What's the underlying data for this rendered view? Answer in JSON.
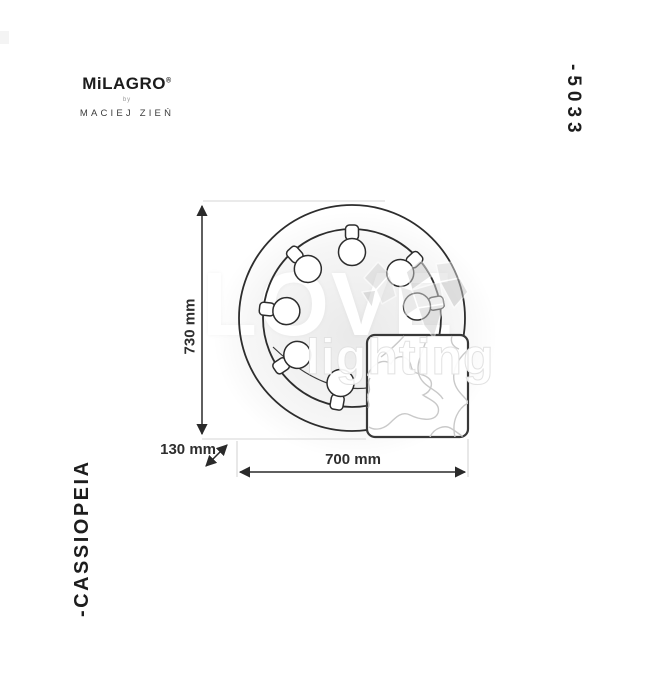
{
  "brand": {
    "name": "MiLAGRO",
    "registered_mark": "®",
    "by_label": "by",
    "designer": "MACIEJ ZIEŃ"
  },
  "product": {
    "model_number": "-5033",
    "name": "-CASSIOPEIA"
  },
  "dimensions": {
    "height": "730 mm",
    "width": "700 mm",
    "depth": "130 mm"
  },
  "watermark": {
    "word_top": "LOVE",
    "word_bottom": "lighting",
    "heart_icon": "faceted-heart-icon",
    "heart_color": "#cfcfcf"
  },
  "diagram": {
    "type": "product-dimension-drawing",
    "fixture": "round ring lamp with 8 inward bulbs and square marble back plate",
    "line_color": "#2d2d2d",
    "extension_line_color": "#d6d6d6",
    "vein_color": "#c9c9c9"
  }
}
